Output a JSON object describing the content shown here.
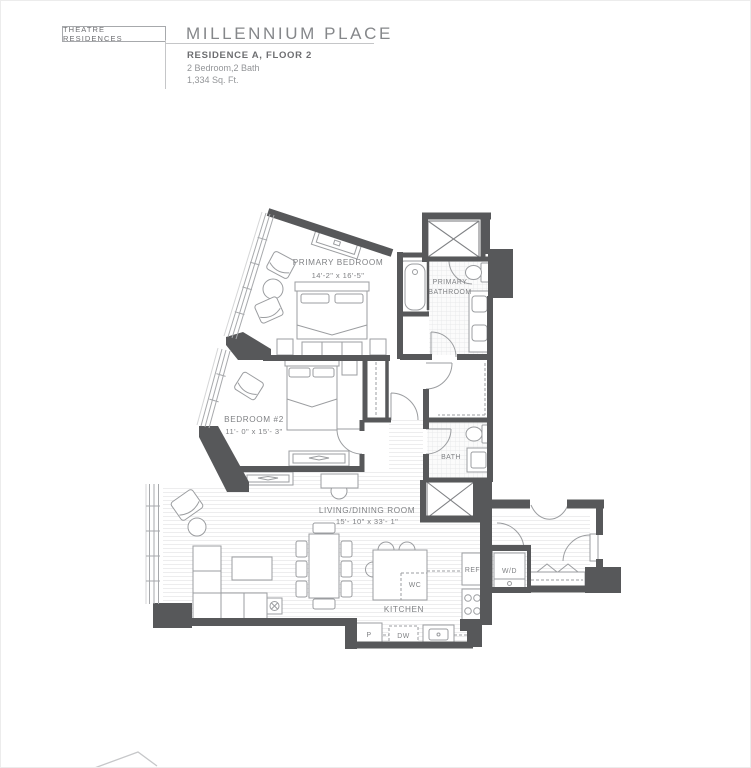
{
  "header": {
    "brand": "THEATRE RESIDENCES",
    "title": "MILLENNIUM PLACE",
    "residence": "RESIDENCE A, FLOOR 2",
    "bedrooms_baths": "2 Bedroom,2 Bath",
    "area": "1,334 Sq. Ft."
  },
  "floorplan": {
    "rooms": {
      "primary_bedroom": {
        "name": "PRIMARY BEDROOM",
        "dims": "14'-2\" x 16'-5\""
      },
      "primary_bathroom": {
        "line1": "PRIMARY",
        "line2": "BATHROOM"
      },
      "bedroom_2": {
        "name": "BEDROOM #2",
        "dims": "11'- 0\" x 15'- 3\""
      },
      "bath": {
        "name": "BATH"
      },
      "living_dining": {
        "name": "LIVING/DINING ROOM",
        "dims": "15'- 10\" x 33'- 1\""
      },
      "kitchen": {
        "name": "KITCHEN"
      }
    },
    "labels": {
      "wine_cooler": "WC",
      "refrigerator": "REF",
      "washer_dryer": "W/D",
      "pantry": "P",
      "dishwasher": "DW"
    },
    "colors": {
      "walls": "#57585a",
      "furniture_line": "#9b9da0",
      "text": "#808285",
      "window_line": "#a7a9ac"
    }
  }
}
